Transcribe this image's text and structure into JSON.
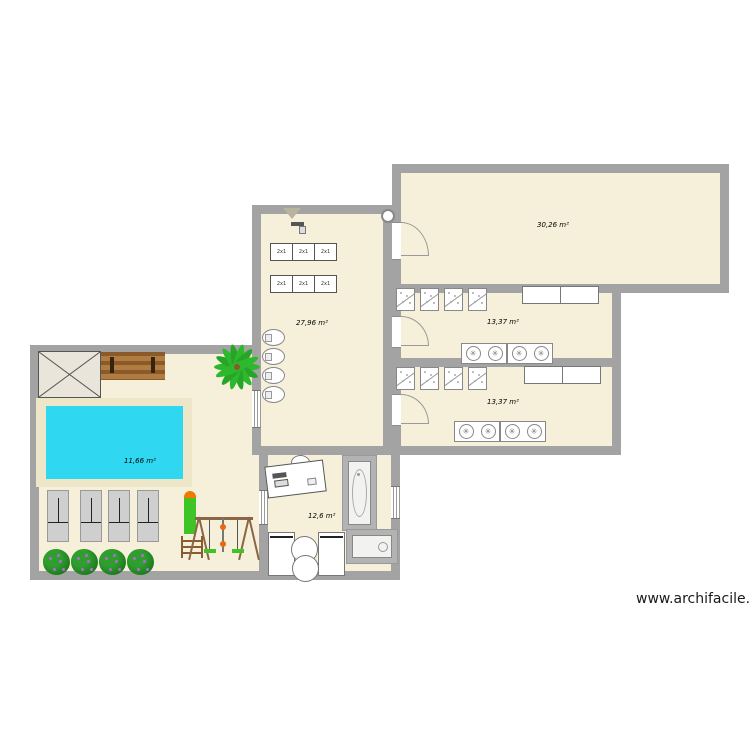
{
  "watermark": "www.archifacile.fr",
  "rooms": {
    "top_right": {
      "area": "30,26 m²"
    },
    "mid_right": {
      "area": "13,37 m²"
    },
    "bottom_right": {
      "area": "13,37 m²"
    },
    "central": {
      "area": "27,96 m²"
    },
    "pool": {
      "area": "11,66 m²"
    },
    "bottom_center": {
      "area": "12,6 m²"
    }
  },
  "objects": {
    "bunk_label": "2x1"
  },
  "colors": {
    "wall": "#a3a3a3",
    "floor": "#f6f0da",
    "pool_water": "#2fd7f0",
    "pool_deck": "#eee6c9",
    "palm_green": "#2eb82e",
    "slide_green": "#3fc426",
    "slide_cap_orange": "#f07a00",
    "bench_brown": "#a0703c"
  }
}
